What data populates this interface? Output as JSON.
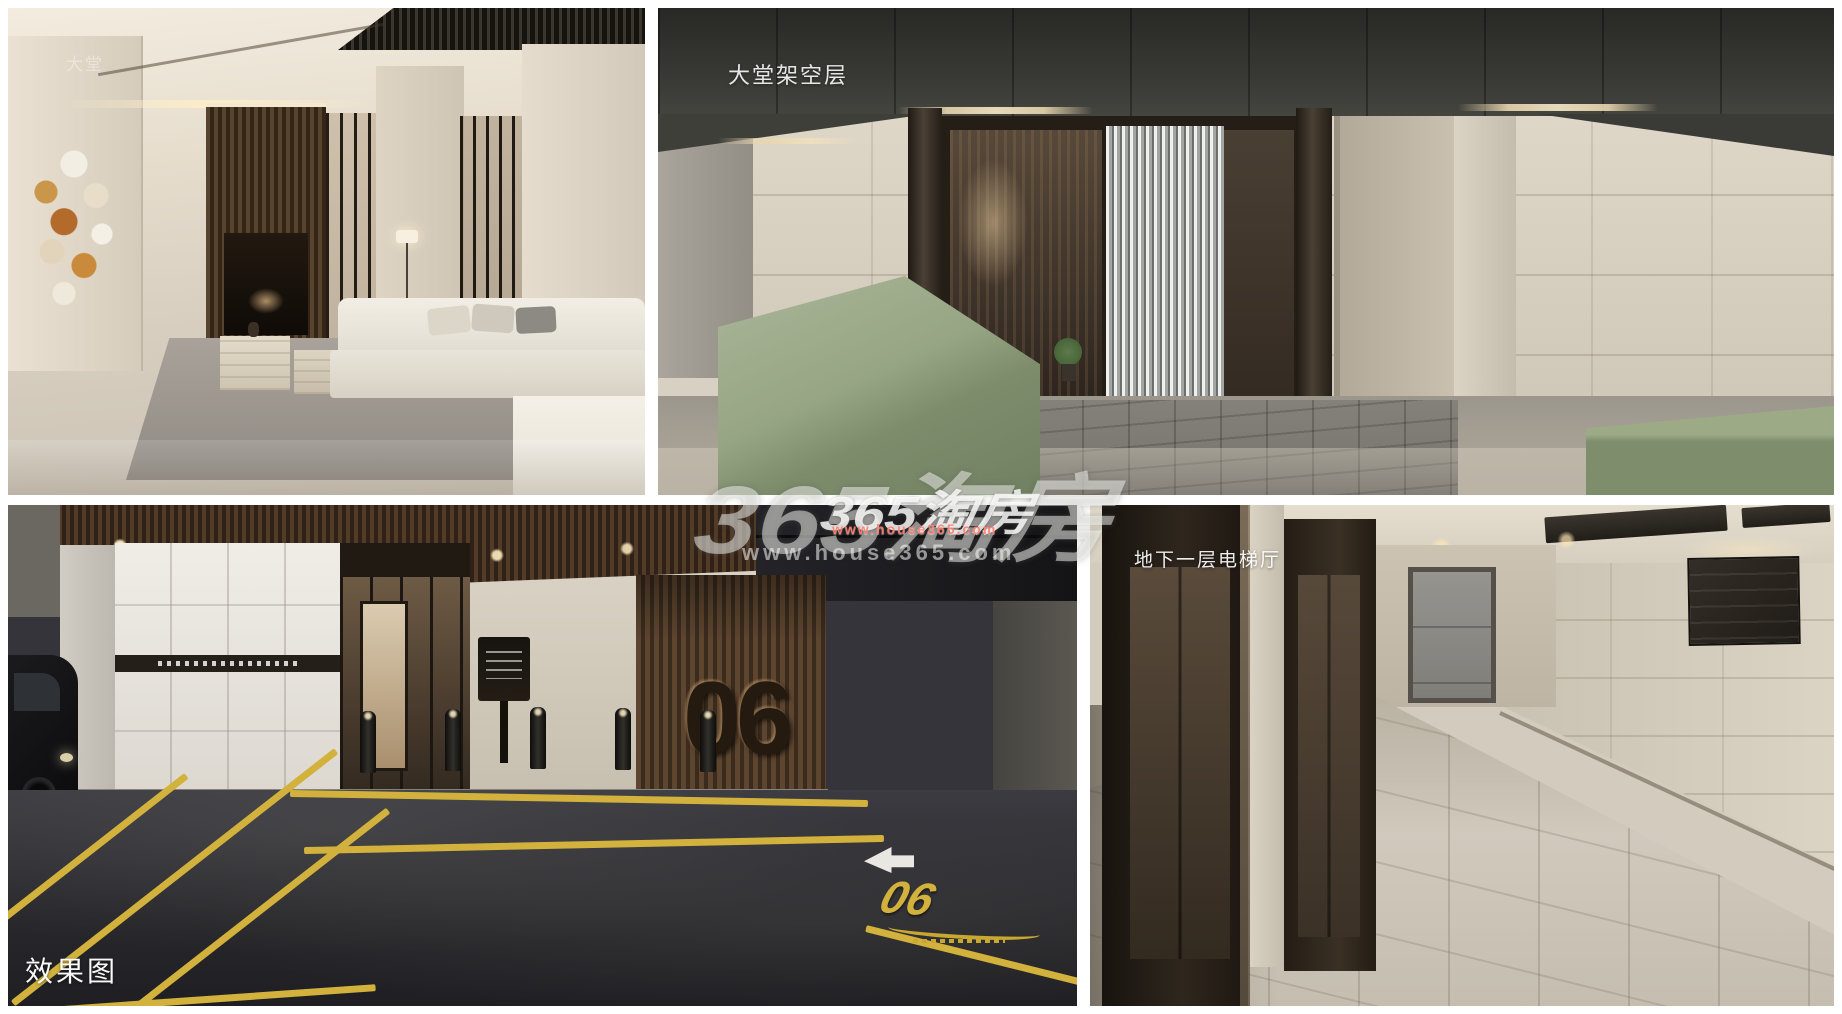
{
  "gallery": {
    "panels": {
      "lobby": {
        "label": "大堂"
      },
      "stilt_floor": {
        "label": "大堂架空层"
      },
      "parking": {
        "label": "效果图",
        "entrance_number": "06",
        "road_marking_number": "06"
      },
      "elevator_hall": {
        "label": "地下一层电梯厅"
      }
    }
  },
  "watermark": {
    "large": {
      "brand": "365淘房",
      "url": "www.house365.com"
    },
    "small": {
      "brand": "365淘房",
      "url": "www.house365.com"
    }
  },
  "colors": {
    "frame_white": "#ffffff",
    "marking_yellow": "#d2b23c",
    "planter_green": "#8b9a79",
    "wood_brown": "#4a3526",
    "bronze_dark": "#2c251e",
    "watermark_url_red": "#ff7d6e"
  }
}
